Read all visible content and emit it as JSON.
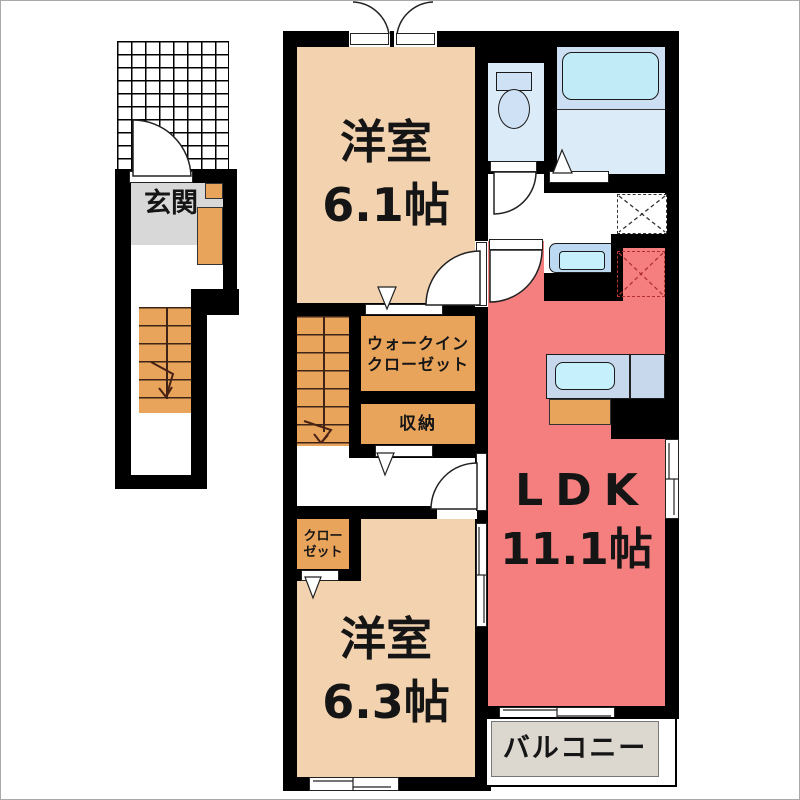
{
  "floorplan": {
    "entrance": {
      "label": "玄関"
    },
    "bedroom1": {
      "name": "洋室",
      "size": "6.1帖"
    },
    "wic": {
      "line1": "ウォークイン",
      "line2": "クローゼット"
    },
    "storage": {
      "label": "収納"
    },
    "closet": {
      "line1": "クロー",
      "line2": "ゼット"
    },
    "bedroom2": {
      "name": "洋室",
      "size": "6.3帖"
    },
    "ldk": {
      "name": "LDK",
      "size": "11.1帖"
    },
    "balcony": {
      "label": "バルコニー"
    }
  },
  "colors": {
    "wall": "#000000",
    "room_floor": "#f3d2b0",
    "closet_orange": "#e9a45c",
    "ldk_red": "#f57f7f",
    "entrance_gray": "#d8d8d8",
    "balcony_gray": "#dcd8d0",
    "water_floor": "#dcebf8",
    "bath_upper": "#cddff2",
    "tub_fill": "#c2ebf8",
    "fixture_blue": "#cfe2f5",
    "counter_blue": "#c7d8ed",
    "sink_fill": "#c6f0fb"
  }
}
